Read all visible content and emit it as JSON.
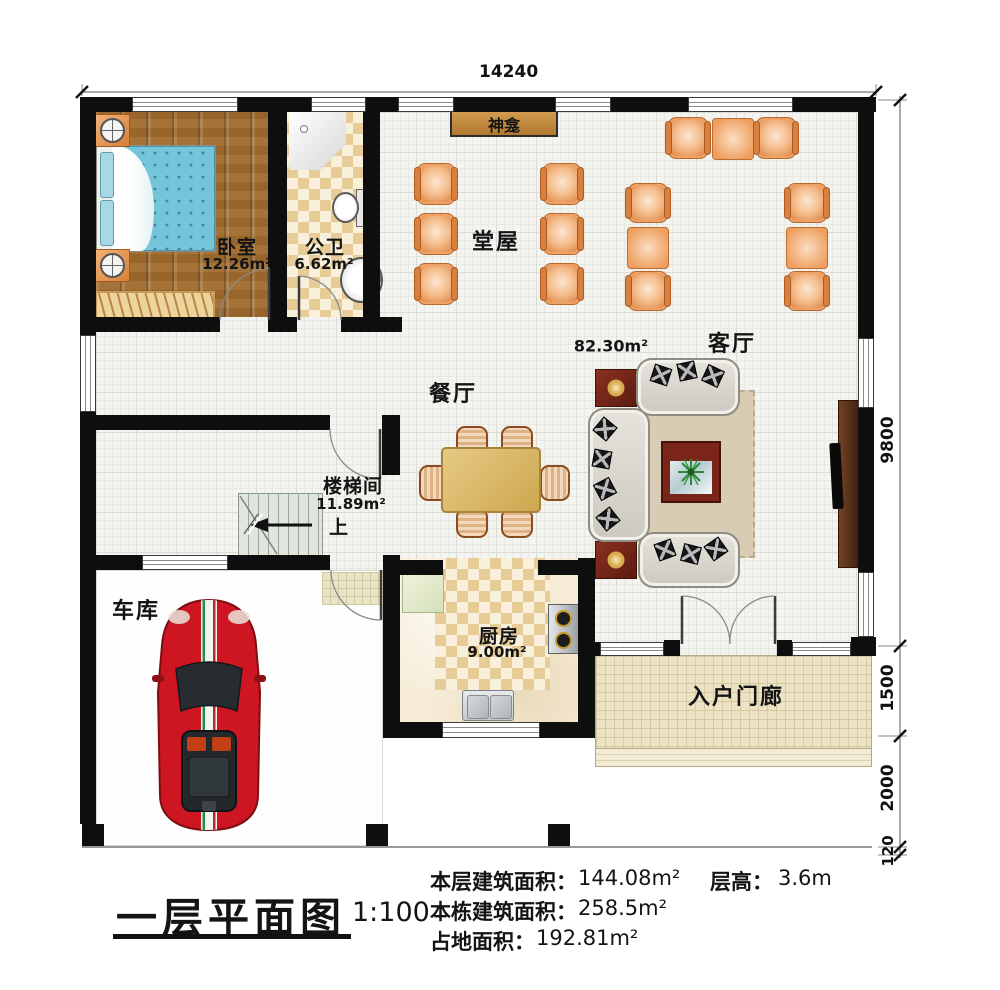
{
  "plan": {
    "rooms": {
      "bedroom": {
        "name": "卧室",
        "area": "12.26m²"
      },
      "bathroom": {
        "name": "公卫",
        "area": "6.62m²"
      },
      "hall": {
        "name": "堂屋"
      },
      "shrine": {
        "name": "神龛"
      },
      "living": {
        "name": "客厅",
        "area": "82.30m²"
      },
      "dining": {
        "name": "餐厅"
      },
      "stairwell": {
        "name": "楼梯间",
        "area": "11.89m²",
        "up": "上"
      },
      "garage": {
        "name": "车库"
      },
      "kitchen": {
        "name": "厨房",
        "area": "9.00m²"
      },
      "porch": {
        "name": "入户门廊"
      }
    },
    "dims": {
      "top": "14240",
      "right": [
        "9800",
        "1500",
        "2000",
        "120"
      ]
    }
  },
  "title_block": {
    "title": "一层平面图",
    "scale": "1:100",
    "floor_area_label": "本层建筑面积：",
    "floor_area_value": "144.08m²",
    "storey_height_label": "层高：",
    "storey_height_value": "3.6m",
    "building_area_label": "本栋建筑面积：",
    "building_area_value": "258.5m²",
    "footprint_label": "占地面积：",
    "footprint_value": "192.81m²"
  },
  "colors": {
    "wall": "#0e0e0e",
    "wood_floor": "#a06a2c",
    "tile_check": "#e7cc98",
    "porch": "#ebe3c3",
    "chair_orange": "#e08a48",
    "sofa_gray": "#d8d5cc",
    "car_red": "#cd1621",
    "shrine_tan": "#c austin"
  }
}
